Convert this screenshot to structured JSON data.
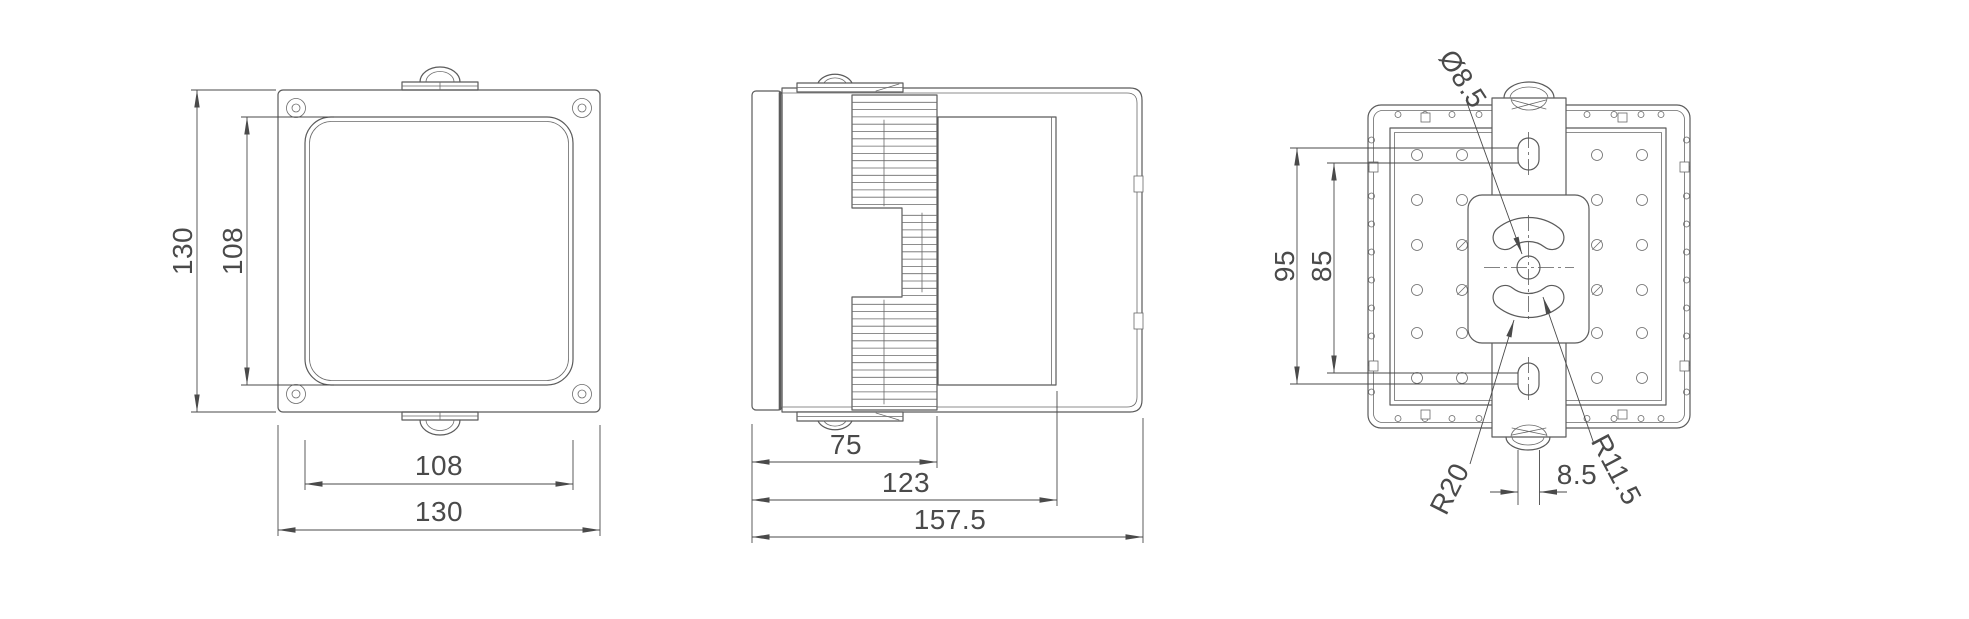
{
  "colors": {
    "background": "#ffffff",
    "line": "#5b5b5b",
    "dimension": "#4a4a4a"
  },
  "views": {
    "front": {
      "dims": {
        "height_outer": "130",
        "height_inner": "108",
        "width_inner": "108",
        "width_outer": "130"
      }
    },
    "side": {
      "dims": {
        "heatsink_depth": "75",
        "body_depth": "123",
        "overall_depth": "157.5"
      }
    },
    "back": {
      "dims": {
        "mount_span_outer": "95",
        "mount_span_inner": "85",
        "hole_diameter": "Ø8.5",
        "slot_radius": "R20",
        "slot_end_radius": "R11.5",
        "slot_width": "8.5"
      }
    }
  }
}
